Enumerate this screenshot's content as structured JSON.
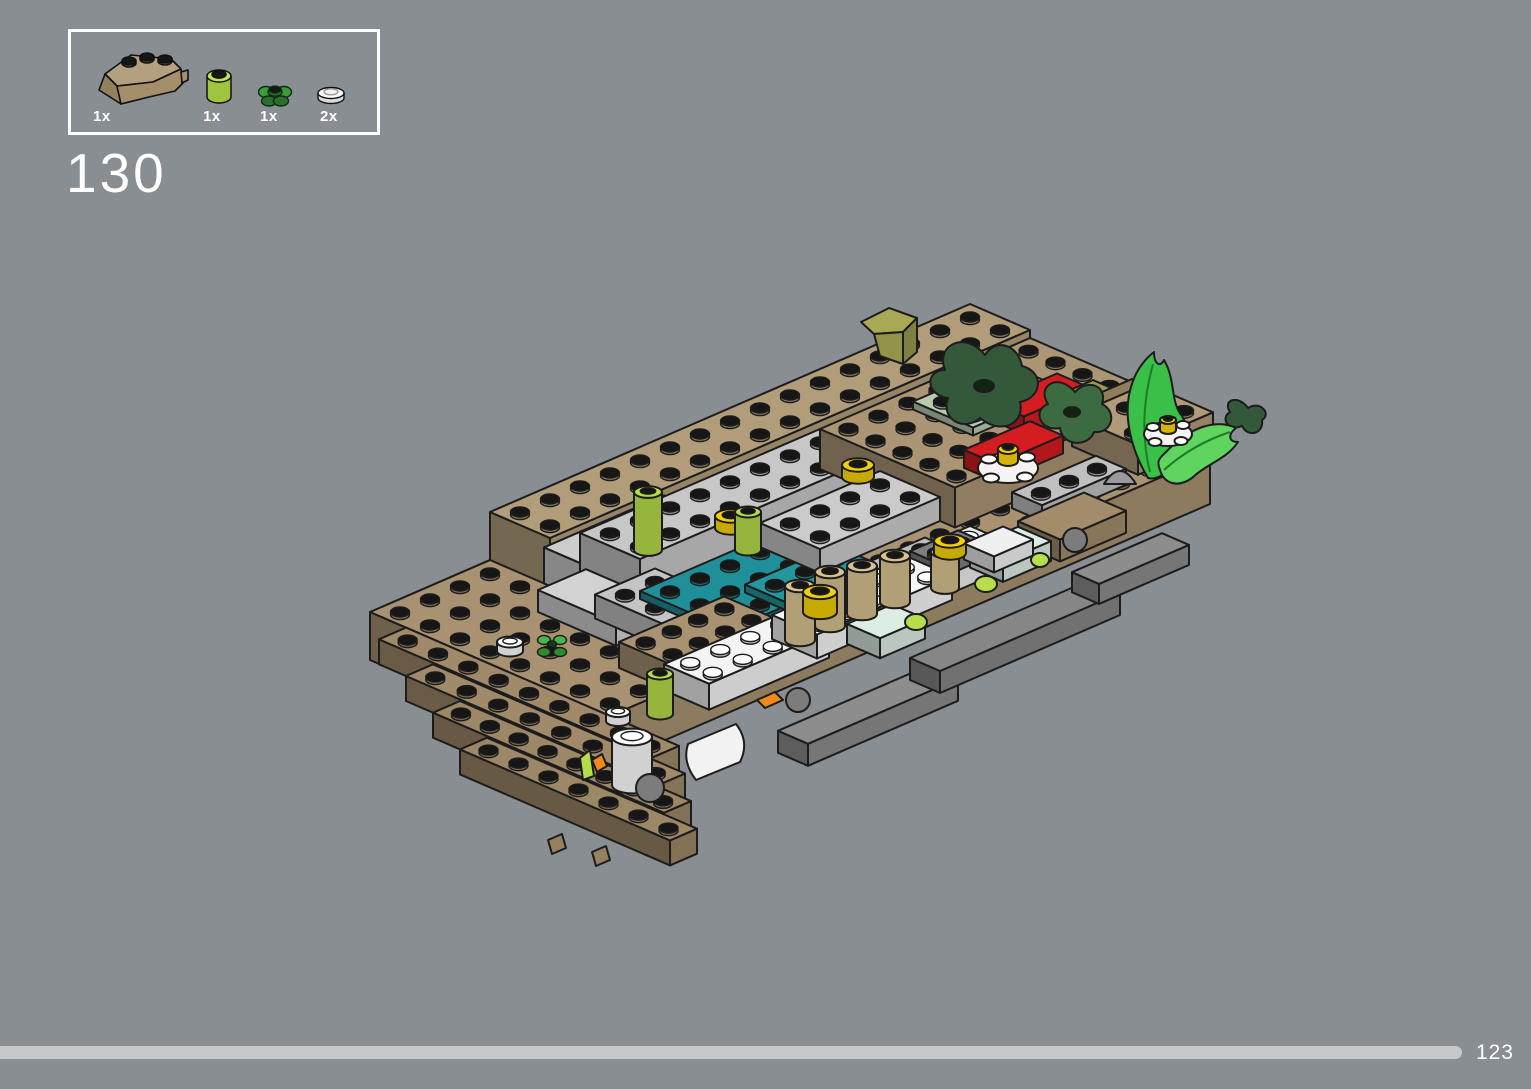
{
  "page": {
    "number": "123",
    "background": "#898e93"
  },
  "step": {
    "number": "130"
  },
  "parts_panel": {
    "parts": [
      {
        "part": "wedge-brick-3x3-dark-tan",
        "qty": "1x",
        "color": "#a89272"
      },
      {
        "part": "round-brick-1x1-lime",
        "qty": "1x",
        "color": "#b7dd4b"
      },
      {
        "part": "flower-plate-green",
        "qty": "1x",
        "color": "#3f9a3f"
      },
      {
        "part": "round-plate-1x1-white",
        "qty": "2x",
        "color": "#ffffff"
      }
    ]
  },
  "colors": {
    "tan": "#a89272",
    "tan_light": "#b29d7b",
    "teal": "#1f9099",
    "red": "#d41d20",
    "lime": "#b7dd4b",
    "yellow": "#f3cf00",
    "yellow_dark": "#d4b400",
    "white": "#f4f4f4",
    "bright_green": "#3abf49",
    "light_green": "#5fd45f",
    "dark_green": "#33593a",
    "dark_green2": "#3c6b42",
    "olive": "#a8a855",
    "olive_mid": "#93934a",
    "olive_dark": "#7f7f3f",
    "orange": "#f08a1d",
    "sphere_gray": "#7c7c7c",
    "stem_green": "#1f7d2a",
    "outline": "#1c1c1c"
  },
  "illustration": {
    "iso": {
      "ox": 370,
      "oy": 620,
      "ux": 30,
      "uy": 13
    },
    "boxes": [
      {
        "n": "hull-base-plate",
        "g": [
          0,
          0,
          20,
          8,
          -40,
          48
        ],
        "c": "#a89272"
      },
      {
        "n": "hull-stair-row",
        "g": [
          -0.9,
          1.2,
          0.9,
          9.1,
          -17,
          25
        ],
        "c": "#a08a6a"
      },
      {
        "n": "hull-stair-row",
        "g": [
          -0.9,
          2.1,
          0.9,
          8.4,
          -42,
          25
        ],
        "c": "#a08a6a"
      },
      {
        "n": "hull-stair-row",
        "g": [
          -0.9,
          3.0,
          0.9,
          7.7,
          -67,
          25
        ],
        "c": "#9c8766"
      },
      {
        "n": "hull-stair-row",
        "g": [
          -0.9,
          3.9,
          0.9,
          7.0,
          -92,
          25
        ],
        "c": "#9c8766"
      },
      {
        "n": "back-wall-tan",
        "g": [
          4,
          0,
          16,
          2,
          8,
          48
        ],
        "c": "#b29d7b"
      },
      {
        "n": "back-gray-bricks",
        "g": [
          4,
          1.8,
          4,
          1.4,
          8,
          36
        ],
        "c": "#cdcdcd",
        "s": 0
      },
      {
        "n": "gray-brick-field",
        "g": [
          5,
          2,
          8,
          2,
          8,
          40
        ],
        "c": "#c7c7c7"
      },
      {
        "n": "right-platform",
        "g": [
          13,
          2,
          7,
          4.5,
          8,
          40
        ],
        "c": "#ab9575"
      },
      {
        "n": "sage-plate",
        "g": [
          15.3,
          2.8,
          3,
          2,
          48,
          8
        ],
        "c": "#bac9b2"
      },
      {
        "n": "red-brick",
        "g": [
          16.5,
          4.2,
          2.2,
          1.1,
          40,
          18
        ],
        "c": "#d41d20",
        "s": 0
      },
      {
        "n": "red-brick",
        "g": [
          14.6,
          5.2,
          2.2,
          1.1,
          30,
          18
        ],
        "c": "#d41d20",
        "s": 0
      },
      {
        "n": "olive-plate-small",
        "g": [
          18.2,
          4.9,
          1,
          0.8,
          46,
          8
        ],
        "c": "#9a9a50",
        "s": 0
      },
      {
        "n": "dark-tan-brick",
        "g": [
          18.8,
          5.2,
          1.4,
          1,
          30,
          16
        ],
        "c": "#917c5b",
        "s": 0
      },
      {
        "n": "tan-arch-block",
        "g": [
          18,
          5.4,
          2.5,
          2.2,
          10,
          30
        ],
        "c": "#b09a7a"
      },
      {
        "n": "gray-slope-left",
        "g": [
          2.8,
          2.8,
          1.6,
          2.6,
          8,
          22
        ],
        "c": "#d2d2d2",
        "s": 0
      },
      {
        "n": "gray-bricks-left",
        "g": [
          3.5,
          4,
          2,
          3,
          8,
          24
        ],
        "c": "#c4c4c4"
      },
      {
        "n": "teal-plate-a",
        "g": [
          5,
          4,
          4,
          3,
          8,
          8
        ],
        "c": "#1f9099"
      },
      {
        "n": "teal-plate-b",
        "g": [
          7,
          5.5,
          3,
          2,
          8,
          8
        ],
        "c": "#24979e"
      },
      {
        "n": "gray-bricks-mid",
        "g": [
          9,
          4,
          4,
          2,
          8,
          24
        ],
        "c": "#cbcbcb"
      },
      {
        "n": "gray-low-row",
        "g": [
          9.5,
          6,
          3,
          1.5,
          -16,
          14
        ],
        "c": "#bdbdbd"
      },
      {
        "n": "white-mid-block",
        "g": [
          11.5,
          6,
          2.5,
          1.5,
          -30,
          20
        ],
        "c": "#ededed",
        "sc": "#ffffff"
      },
      {
        "n": "dark-gray-plate",
        "g": [
          11.8,
          6.2,
          1.6,
          1,
          -18,
          14
        ],
        "c": "#7e7e7e"
      },
      {
        "n": "tan-wedge-center",
        "g": [
          2,
          6.3,
          3.5,
          2.7,
          8,
          26
        ],
        "c": "#a89272"
      },
      {
        "n": "gray-row-right",
        "g": [
          15,
          6.4,
          2.8,
          1,
          0,
          16
        ],
        "c": "#c0c0c0"
      },
      {
        "n": "tan-right-face",
        "g": [
          14.6,
          7.0,
          2.2,
          1.4,
          -22,
          22
        ],
        "c": "#a28c6c",
        "s": 0
      },
      {
        "n": "aqua-panel",
        "g": [
          13.4,
          6.6,
          1.6,
          1.1,
          -36,
          20
        ],
        "c": "#dcede4",
        "s": 0
      },
      {
        "n": "white-small-panel",
        "g": [
          13,
          6.8,
          1.3,
          1,
          -20,
          16
        ],
        "c": "#f0f0f0",
        "s": 0
      },
      {
        "n": "white-wall-a",
        "g": [
          2.2,
          7.6,
          4,
          1.5,
          0,
          26
        ],
        "c": "#f4f4f4",
        "sc": "#ffffff"
      },
      {
        "n": "white-wall-b",
        "g": [
          6.2,
          7.2,
          4.5,
          1.5,
          -6,
          24
        ],
        "c": "#f6f6f6",
        "sc": "#ffffff"
      },
      {
        "n": "aqua-panel-front",
        "g": [
          7.8,
          8.1,
          1.5,
          1.1,
          -20,
          20
        ],
        "c": "#dcede4",
        "s": 0
      },
      {
        "n": "dark-hull-strip",
        "g": [
          4,
          9.6,
          5,
          1,
          -60,
          22
        ],
        "c": "#8d8d8d",
        "s": 0
      },
      {
        "n": "dark-hull-strip",
        "g": [
          9,
          9.0,
          6,
          1,
          -60,
          22
        ],
        "c": "#868686",
        "s": 0
      },
      {
        "n": "dark-hull-strip",
        "g": [
          15,
          8.4,
          3,
          0.9,
          -58,
          20
        ],
        "c": "#8d8d8d",
        "s": 0
      }
    ],
    "cyls": [
      {
        "n": "white-round-plate",
        "x": 510,
        "y": 642,
        "h": 9,
        "r": 13,
        "c": "#ffffff",
        "sc": "#ffffff"
      },
      {
        "n": "white-round-plate",
        "x": 618,
        "y": 712,
        "h": 9,
        "r": 12,
        "c": "#ffffff",
        "sc": "#ffffff"
      },
      {
        "n": "white-barrel",
        "x": 632,
        "y": 737,
        "h": 48,
        "r": 20,
        "c": "#ffffff",
        "sc": "#ffffff"
      },
      {
        "n": "tan-round-brick",
        "x": 800,
        "y": 586,
        "h": 54,
        "r": 15,
        "c": "#d8c290"
      },
      {
        "n": "tan-round-brick",
        "x": 830,
        "y": 572,
        "h": 54,
        "r": 15,
        "c": "#d8c290"
      },
      {
        "n": "tan-round-brick",
        "x": 862,
        "y": 566,
        "h": 48,
        "r": 15,
        "c": "#d8c290"
      },
      {
        "n": "tan-round-brick",
        "x": 895,
        "y": 556,
        "h": 46,
        "r": 15,
        "c": "#d8c290"
      },
      {
        "n": "tan-round-brick",
        "x": 945,
        "y": 552,
        "h": 36,
        "r": 14,
        "c": "#d8c290"
      },
      {
        "n": "yellow-round-plate",
        "x": 731,
        "y": 516,
        "h": 12,
        "r": 16,
        "c": "#f3cf00"
      },
      {
        "n": "yellow-round-plate",
        "x": 858,
        "y": 465,
        "h": 12,
        "r": 16,
        "c": "#f3cf00"
      },
      {
        "n": "yellow-round-plate",
        "x": 820,
        "y": 592,
        "h": 20,
        "r": 17,
        "c": "#f3cf00"
      },
      {
        "n": "yellow-round-plate",
        "x": 950,
        "y": 541,
        "h": 12,
        "r": 16,
        "c": "#f3cf00"
      },
      {
        "n": "lime-round-brick",
        "x": 648,
        "y": 492,
        "h": 58,
        "r": 14,
        "c": "#b7dd4b"
      },
      {
        "n": "lime-round-brick",
        "x": 748,
        "y": 512,
        "h": 38,
        "r": 13,
        "c": "#b7dd4b"
      },
      {
        "n": "lime-round-brick",
        "x": 660,
        "y": 674,
        "h": 40,
        "r": 13,
        "c": "#b7dd4b"
      }
    ]
  }
}
